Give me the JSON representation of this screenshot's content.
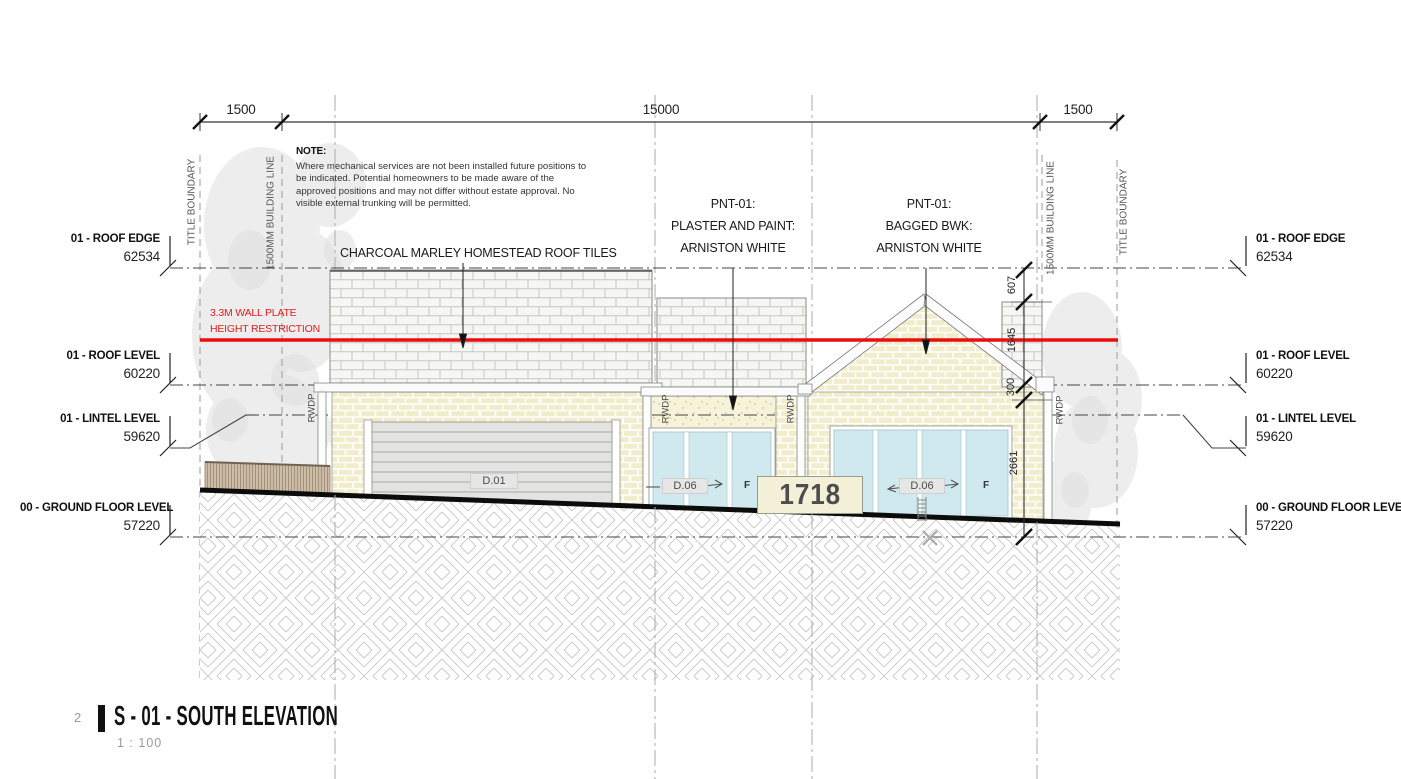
{
  "header_dimensions": {
    "left": "1500",
    "middle": "15000",
    "right": "1500"
  },
  "note": {
    "heading": "NOTE:",
    "body": "Where mechanical services are not been installed future positions to be indicated. Potential homeowners to be made aware of the approved positions and may not differ without estate approval. No visible external trunking will be permitted."
  },
  "boundaries": {
    "title_left": "TITLE BOUNDARY",
    "building_left": "1500MM BUILDING LINE",
    "building_right": "1500MM BUILDING LINE",
    "title_right": "TITLE BOUNDARY"
  },
  "levels": {
    "left": [
      {
        "label": "01 - ROOF EDGE",
        "value": "62534"
      },
      {
        "label": "01 - ROOF LEVEL",
        "value": "60220"
      },
      {
        "label": "01 - LINTEL LEVEL",
        "value": "59620"
      },
      {
        "label": "00 - GROUND FLOOR LEVEL",
        "value": "57220"
      }
    ],
    "right": [
      {
        "label": "01 - ROOF EDGE",
        "value": "62534"
      },
      {
        "label": "01 - ROOF LEVEL",
        "value": "60220"
      },
      {
        "label": "01 - LINTEL LEVEL",
        "value": "59620"
      },
      {
        "label": "00 - GROUND FLOOR LEVEL",
        "value": "57220"
      }
    ]
  },
  "annotations": {
    "roof_tiles": "CHARCOAL MARLEY HOMESTEAD ROOF TILES",
    "pnt_plaster": {
      "line1": "PNT-01:",
      "line2": "PLASTER AND PAINT:",
      "line3": "ARNISTON WHITE"
    },
    "pnt_bagged": {
      "line1": "PNT-01:",
      "line2": "BAGGED BWK:",
      "line3": "ARNISTON WHITE"
    },
    "height_restriction": {
      "line1": "3.3M WALL PLATE",
      "line2": "HEIGHT RESTRICTION"
    },
    "rwdp": "RWDP",
    "house_number": "1718",
    "f_marker": "F"
  },
  "doors": {
    "garage": "D.01",
    "mid": "D.06",
    "right": "D.06"
  },
  "side_dimensions": {
    "d607": "607",
    "d1645": "1645",
    "d300": "300",
    "d2661": "2661"
  },
  "titleblock": {
    "number": "2",
    "title": "S - 01 - SOUTH ELEVATION",
    "scale": "1 : 100"
  },
  "colors": {
    "restriction_red": "#e31c1c",
    "brick_bagged": "#f1ecc9",
    "roof_tiles": "#f6f6f4",
    "plaster": "#f7f3da",
    "glass": "#cfe9ee",
    "ground_line": "#0c0c0c"
  }
}
